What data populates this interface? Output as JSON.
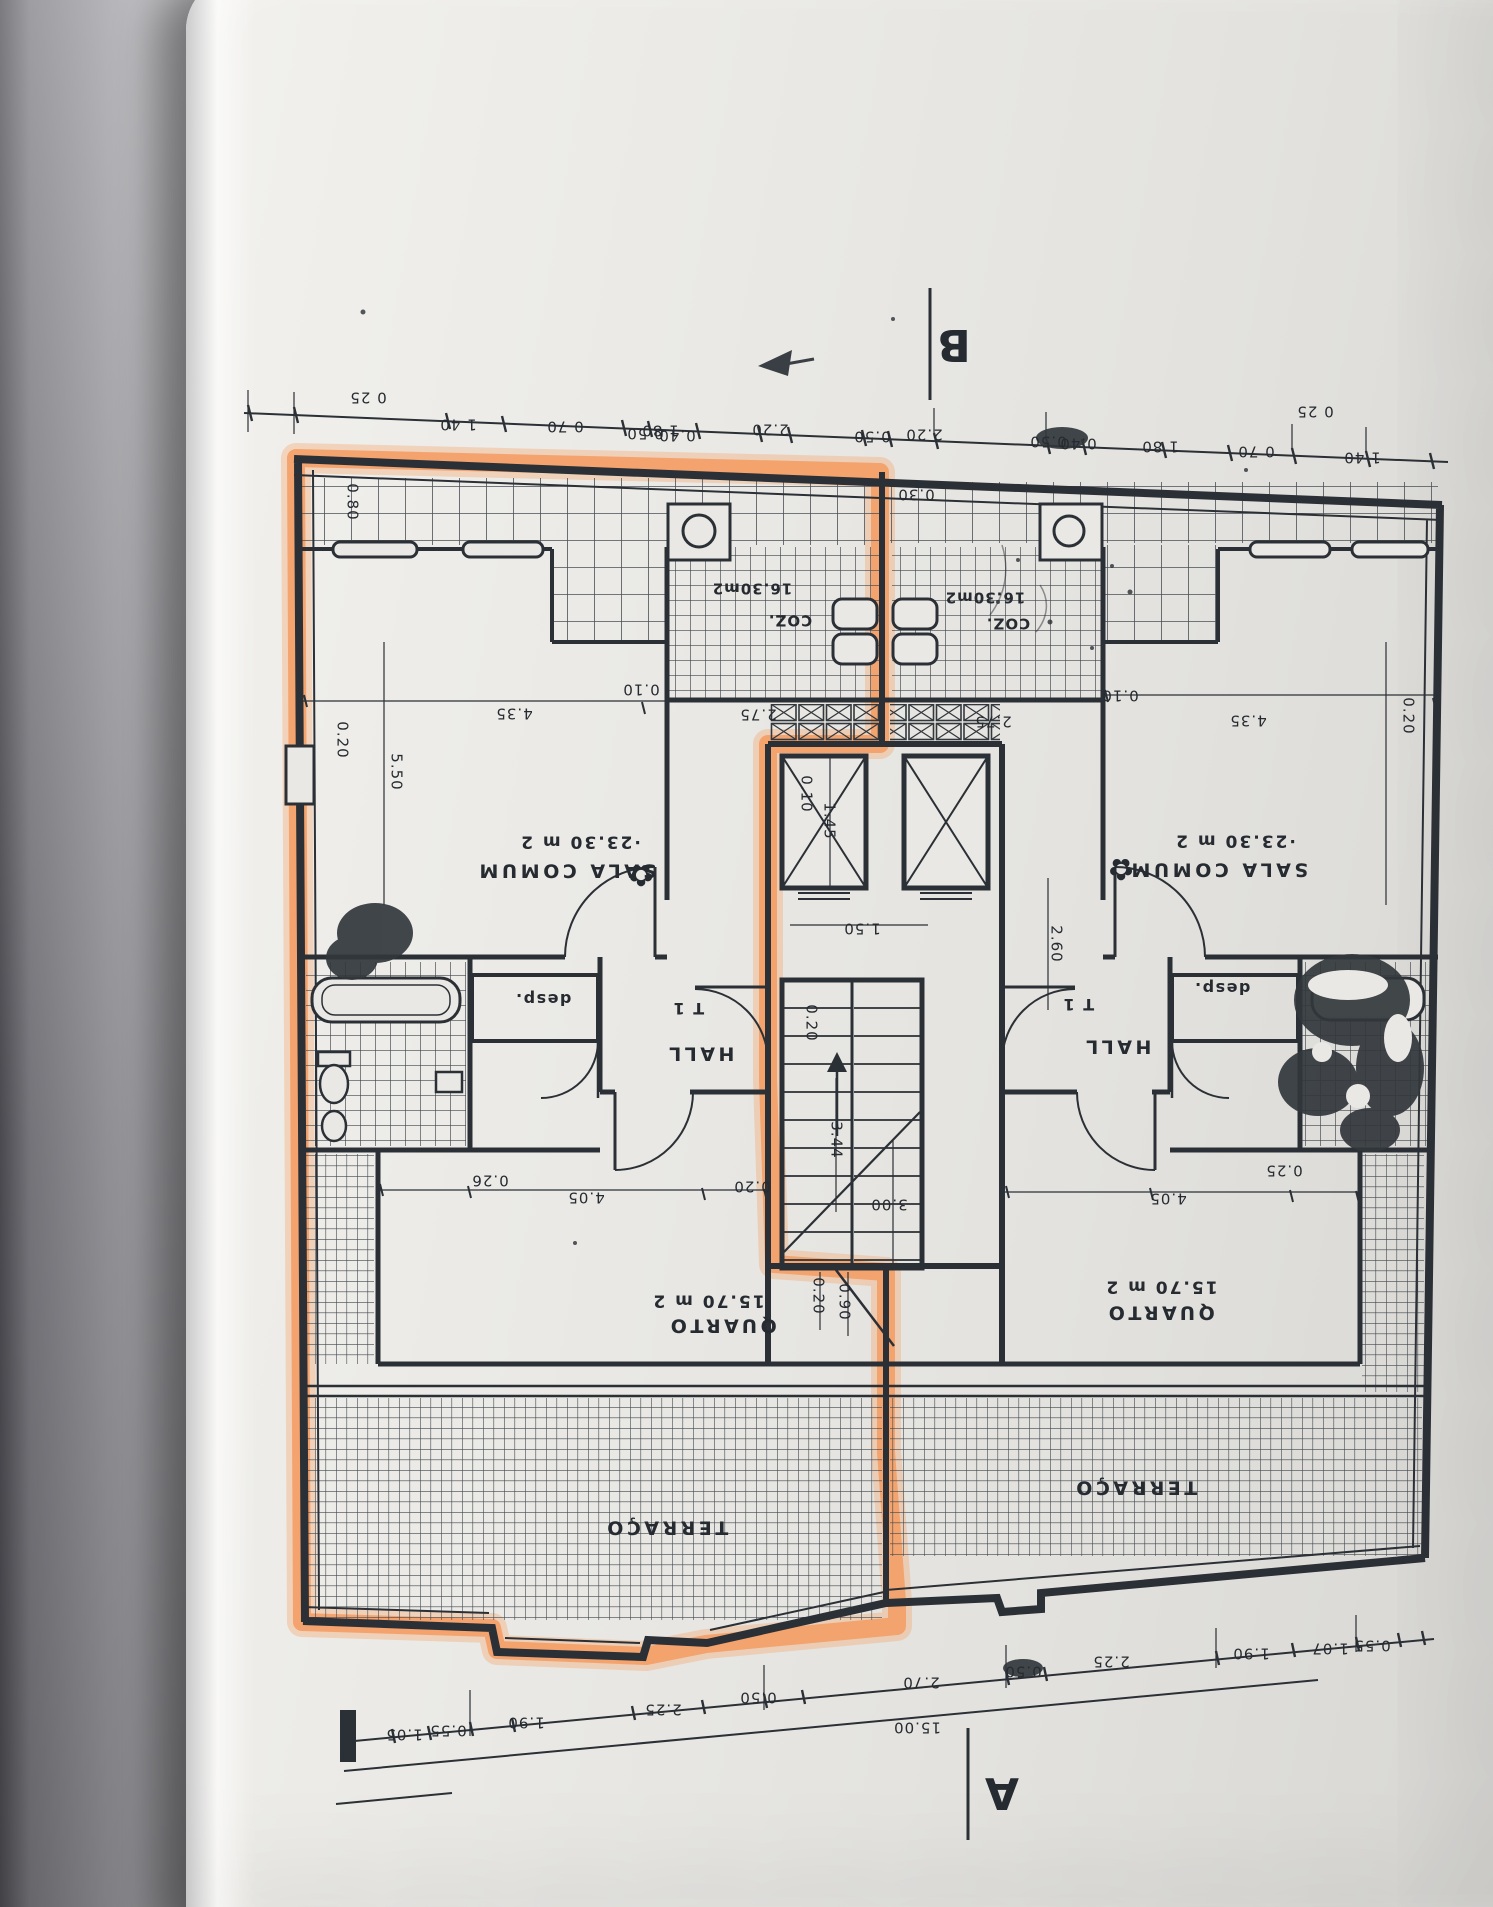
{
  "document": {
    "kind": "architectural floor plan photographed on paper, drawing upside-down",
    "highlight_color": "#f59b60",
    "ink_color": "#2b3036"
  },
  "plan": {
    "markers": [
      {
        "t": "B",
        "x": 954,
        "y": 344,
        "name": "section-marker-b"
      },
      {
        "t": "A",
        "x": 1002,
        "y": 1792,
        "name": "section-marker-a"
      }
    ],
    "icons": [
      {
        "t": "✿",
        "x": 641,
        "y": 874,
        "name": "plant-icon"
      },
      {
        "t": "✿",
        "x": 1121,
        "y": 868,
        "name": "plant-icon"
      }
    ],
    "rooms": [
      {
        "t": "·23.30 m 2",
        "x": 580,
        "y": 841,
        "cls": "area"
      },
      {
        "t": "SALA COMUM",
        "x": 566,
        "y": 870,
        "cls": "room"
      },
      {
        "t": "·23.30 m 2",
        "x": 1235,
        "y": 840,
        "cls": "area"
      },
      {
        "t": "SALA COMUM",
        "x": 1218,
        "y": 869,
        "cls": "room"
      },
      {
        "t": "16.30m2",
        "x": 752,
        "y": 588,
        "cls": "coz"
      },
      {
        "t": "COZ.",
        "x": 790,
        "y": 620,
        "cls": "coz"
      },
      {
        "t": "16.30m2",
        "x": 985,
        "y": 597,
        "cls": "coz"
      },
      {
        "t": "COZ.",
        "x": 1008,
        "y": 623,
        "cls": "coz"
      },
      {
        "t": "T 1",
        "x": 688,
        "y": 1008,
        "cls": "small"
      },
      {
        "t": "HALL",
        "x": 700,
        "y": 1053,
        "cls": "room"
      },
      {
        "t": "T 1",
        "x": 1078,
        "y": 1004,
        "cls": "small"
      },
      {
        "t": "HALL",
        "x": 1117,
        "y": 1046,
        "cls": "room"
      },
      {
        "t": "desp.",
        "x": 543,
        "y": 999,
        "cls": "small"
      },
      {
        "t": "desp.",
        "x": 1222,
        "y": 988,
        "cls": "small"
      },
      {
        "t": "15.70 m 2",
        "x": 708,
        "y": 1300,
        "cls": "area"
      },
      {
        "t": "QUARTO",
        "x": 722,
        "y": 1325,
        "cls": "room"
      },
      {
        "t": "15.70 m 2",
        "x": 1161,
        "y": 1286,
        "cls": "area"
      },
      {
        "t": "QUARTO",
        "x": 1160,
        "y": 1312,
        "cls": "room"
      },
      {
        "t": "TERRAÇO",
        "x": 666,
        "y": 1527,
        "cls": "room"
      },
      {
        "t": "TERRAÇO",
        "x": 1135,
        "y": 1487,
        "cls": "room"
      }
    ],
    "dimensions": [
      {
        "t": "0 25",
        "x": 368,
        "y": 397
      },
      {
        "t": "1 40",
        "x": 458,
        "y": 424
      },
      {
        "t": "0 70",
        "x": 565,
        "y": 426
      },
      {
        "t": "1 80",
        "x": 660,
        "y": 430
      },
      {
        "t": "0.50",
        "x": 645,
        "y": 433
      },
      {
        "t": "0.40",
        "x": 677,
        "y": 435
      },
      {
        "t": "2.20",
        "x": 770,
        "y": 429
      },
      {
        "t": "0.50",
        "x": 872,
        "y": 436
      },
      {
        "t": "2.20",
        "x": 924,
        "y": 434
      },
      {
        "t": "0.50",
        "x": 1048,
        "y": 441
      },
      {
        "t": "0.40",
        "x": 1078,
        "y": 443
      },
      {
        "t": "1 80",
        "x": 1160,
        "y": 446
      },
      {
        "t": "0 70",
        "x": 1256,
        "y": 451
      },
      {
        "t": "1 40",
        "x": 1362,
        "y": 457
      },
      {
        "t": "0 25",
        "x": 1315,
        "y": 411
      },
      {
        "t": "0.30",
        "x": 916,
        "y": 494
      },
      {
        "t": "0.80",
        "x": 352,
        "y": 502,
        "r": "v"
      },
      {
        "t": "0.20",
        "x": 342,
        "y": 740,
        "r": "v"
      },
      {
        "t": "5.50",
        "x": 396,
        "y": 772,
        "r": "v"
      },
      {
        "t": "0.20",
        "x": 1408,
        "y": 716,
        "r": "v"
      },
      {
        "t": "0.10",
        "x": 641,
        "y": 689
      },
      {
        "t": "4.35",
        "x": 514,
        "y": 713
      },
      {
        "t": "0.10",
        "x": 1120,
        "y": 695
      },
      {
        "t": "4.35",
        "x": 1248,
        "y": 720
      },
      {
        "t": "2.75",
        "x": 758,
        "y": 714
      },
      {
        "t": "2.75",
        "x": 993,
        "y": 721
      },
      {
        "t": "0.10",
        "x": 806,
        "y": 794,
        "r": "v"
      },
      {
        "t": "1.45",
        "x": 829,
        "y": 821,
        "r": "v"
      },
      {
        "t": "1.50",
        "x": 862,
        "y": 928
      },
      {
        "t": "2.60",
        "x": 1056,
        "y": 944,
        "r": "v"
      },
      {
        "t": "0.20",
        "x": 811,
        "y": 1023,
        "r": "v"
      },
      {
        "t": "3.44",
        "x": 836,
        "y": 1140,
        "r": "v"
      },
      {
        "t": "3.00",
        "x": 889,
        "y": 1204
      },
      {
        "t": "0.20",
        "x": 752,
        "y": 1186
      },
      {
        "t": "0.26",
        "x": 490,
        "y": 1180
      },
      {
        "t": "4.05",
        "x": 586,
        "y": 1197
      },
      {
        "t": "0.25",
        "x": 1284,
        "y": 1170
      },
      {
        "t": "4.05",
        "x": 1168,
        "y": 1198
      },
      {
        "t": "0.20",
        "x": 818,
        "y": 1296,
        "r": "v"
      },
      {
        "t": "0.90",
        "x": 844,
        "y": 1302,
        "r": "v"
      },
      {
        "t": "1.05",
        "x": 404,
        "y": 1734
      },
      {
        "t": "0.55",
        "x": 448,
        "y": 1730
      },
      {
        "t": "1.90",
        "x": 526,
        "y": 1722
      },
      {
        "t": "2.25",
        "x": 663,
        "y": 1709
      },
      {
        "t": "0.50",
        "x": 758,
        "y": 1697
      },
      {
        "t": "2.70",
        "x": 921,
        "y": 1682
      },
      {
        "t": "0.50",
        "x": 1023,
        "y": 1671
      },
      {
        "t": "2.25",
        "x": 1111,
        "y": 1661
      },
      {
        "t": "1.90",
        "x": 1251,
        "y": 1653
      },
      {
        "t": "1.07",
        "x": 1330,
        "y": 1648
      },
      {
        "t": "0.55",
        "x": 1372,
        "y": 1645
      },
      {
        "t": "15.00",
        "x": 917,
        "y": 1727
      }
    ]
  }
}
